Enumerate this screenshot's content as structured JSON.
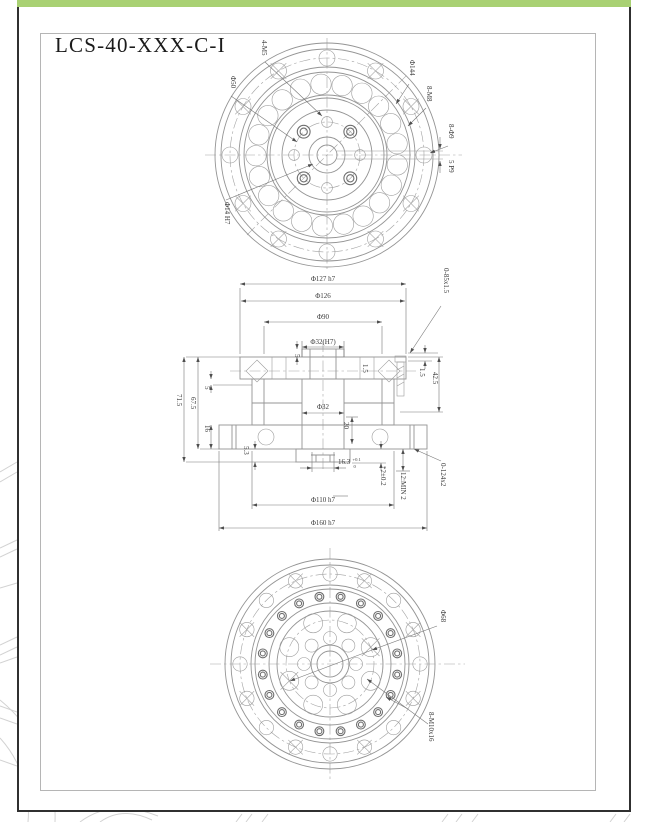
{
  "page": {
    "title": "LCS-40-XXX-C-I",
    "colors": {
      "accent_green": "#a9d173",
      "card_border": "#303030",
      "frame_gray": "#b5b5b5",
      "line_gray": "#949494",
      "text_gray": "#3a3a3a"
    }
  },
  "top_view": {
    "labels": {
      "screws": "4-M5",
      "bolt_circle_50": "Φ50",
      "bolt_circle_144": "Φ144",
      "tapped_holes": "8-M8",
      "through_holes": "8-Φ9",
      "keyway": "5 P9",
      "bore": "Φ14 H7"
    }
  },
  "section_view": {
    "top_dims": {
      "d127": "Φ127 h7",
      "d126": "Φ126",
      "d90": "Φ90",
      "d32_h7": "Φ32(H7)"
    },
    "left_dims": {
      "h715": "71.5",
      "h675": "67.5",
      "t5": "5",
      "h16": "16",
      "h53": "5.3"
    },
    "right_dims": {
      "oring_top": "0-85x1.5",
      "t15_outer": "1.5",
      "t15_inner": "1.5",
      "h425": "42.5",
      "thread_min": "12:MIN 2",
      "oring_bottom": "0-124x2",
      "tol2": "*2±0.2"
    },
    "center_dims": {
      "d32": "Φ32",
      "h20": "20",
      "t5": "5",
      "w163": "16.3",
      "w163_upper": "+0.1",
      "w163_lower": "0"
    },
    "bottom_dims": {
      "d110": "Φ110 h7",
      "d160": "Φ160 h7"
    }
  },
  "bottom_view": {
    "labels": {
      "bolt_circle_68": "Φ68",
      "tapped_holes": "8-M10x16"
    }
  }
}
